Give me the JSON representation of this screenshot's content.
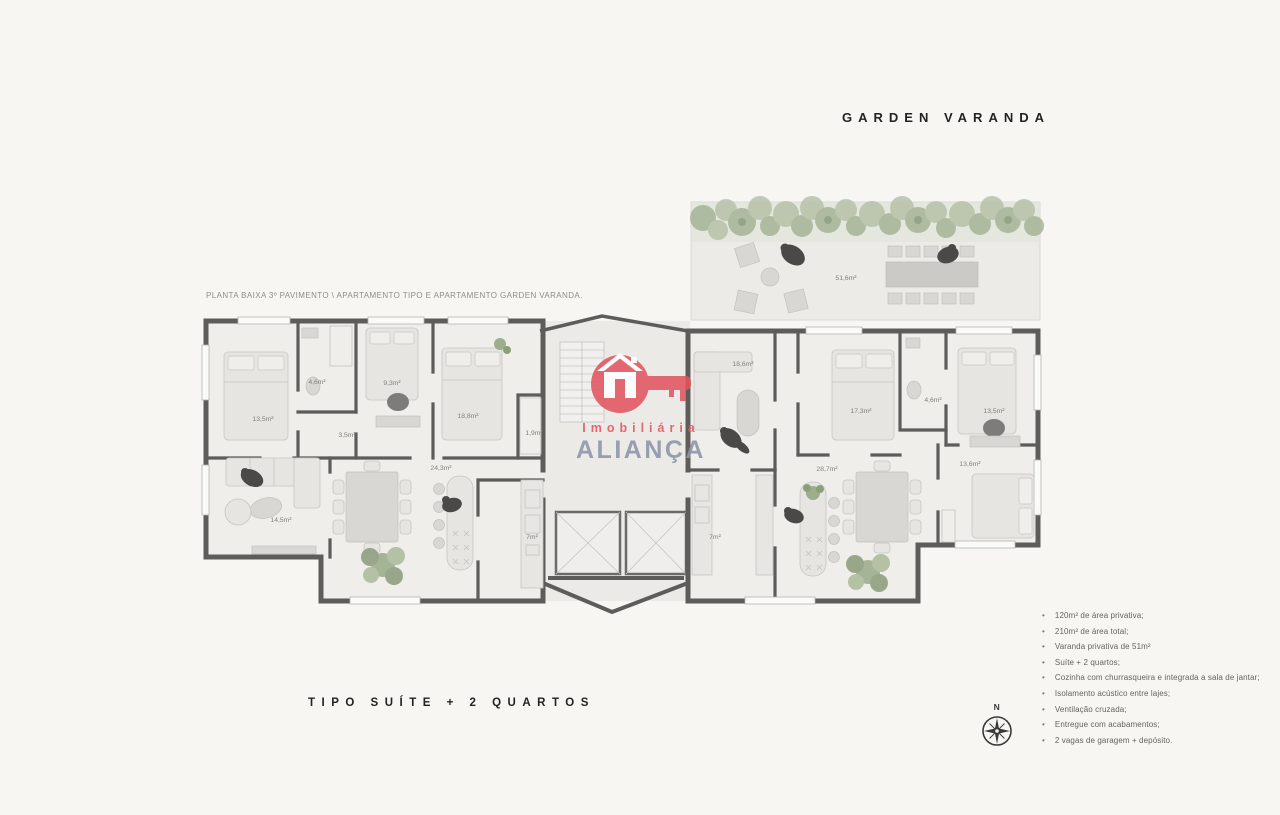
{
  "title": "GARDEN VARANDA",
  "caption": "PLANTA BAIXA 3º PAVIMENTO \\ APARTAMENTO TIPO E APARTAMENTO GARDEN VARANDA.",
  "type_label": "TIPO SUÍTE + 2 QUARTOS",
  "compass": {
    "north_label": "N"
  },
  "logo": {
    "line1": "Imobiliária",
    "line2": "ALIANÇA"
  },
  "colors": {
    "logo-red": "#e25560",
    "logo-gray": "#8c95a7",
    "wall": "#5d5c5a",
    "plant-green": "#9dad8d",
    "text-dark": "#232323",
    "text-muted": "#8f8d89"
  },
  "features": {
    "items": [
      "120m² de área privativa;",
      "210m² de área total;",
      "Varanda privativa de 51m²",
      "Suíte + 2 quartos;",
      "Cozinha com churrasqueira e integrada a sala de jantar;",
      "Isolamento acústico entre lajes;",
      "Ventilação cruzada;",
      "Entregue com acabamentos;",
      "2 vagas de garagem + depósito."
    ]
  },
  "plan": {
    "rooms": [
      {
        "name": "garden-terrace",
        "label": "51,6m²"
      },
      {
        "name": "bedroom-left-1",
        "label": "13,5m²"
      },
      {
        "name": "bathroom-left",
        "label": "4,6m²"
      },
      {
        "name": "bedroom-left-2",
        "label": "9,3m²"
      },
      {
        "name": "hall-left",
        "label": "3,5m²"
      },
      {
        "name": "suite-left",
        "label": "18,8m²"
      },
      {
        "name": "closet-left",
        "label": "1,9m²"
      },
      {
        "name": "dining-left",
        "label": "24,3m²"
      },
      {
        "name": "living-left",
        "label": "14,5m²"
      },
      {
        "name": "kitchen-left",
        "label": "7m²"
      },
      {
        "name": "family-right",
        "label": "18,6m²"
      },
      {
        "name": "bedroom-right-1",
        "label": "17,3m²"
      },
      {
        "name": "bathroom-right",
        "label": "4,6m²"
      },
      {
        "name": "bedroom-right-2",
        "label": "13,5m²"
      },
      {
        "name": "living-right",
        "label": "28,7m²"
      },
      {
        "name": "bedroom-right-3",
        "label": "13,6m²"
      },
      {
        "name": "kitchen-right",
        "label": "7m²"
      }
    ]
  }
}
